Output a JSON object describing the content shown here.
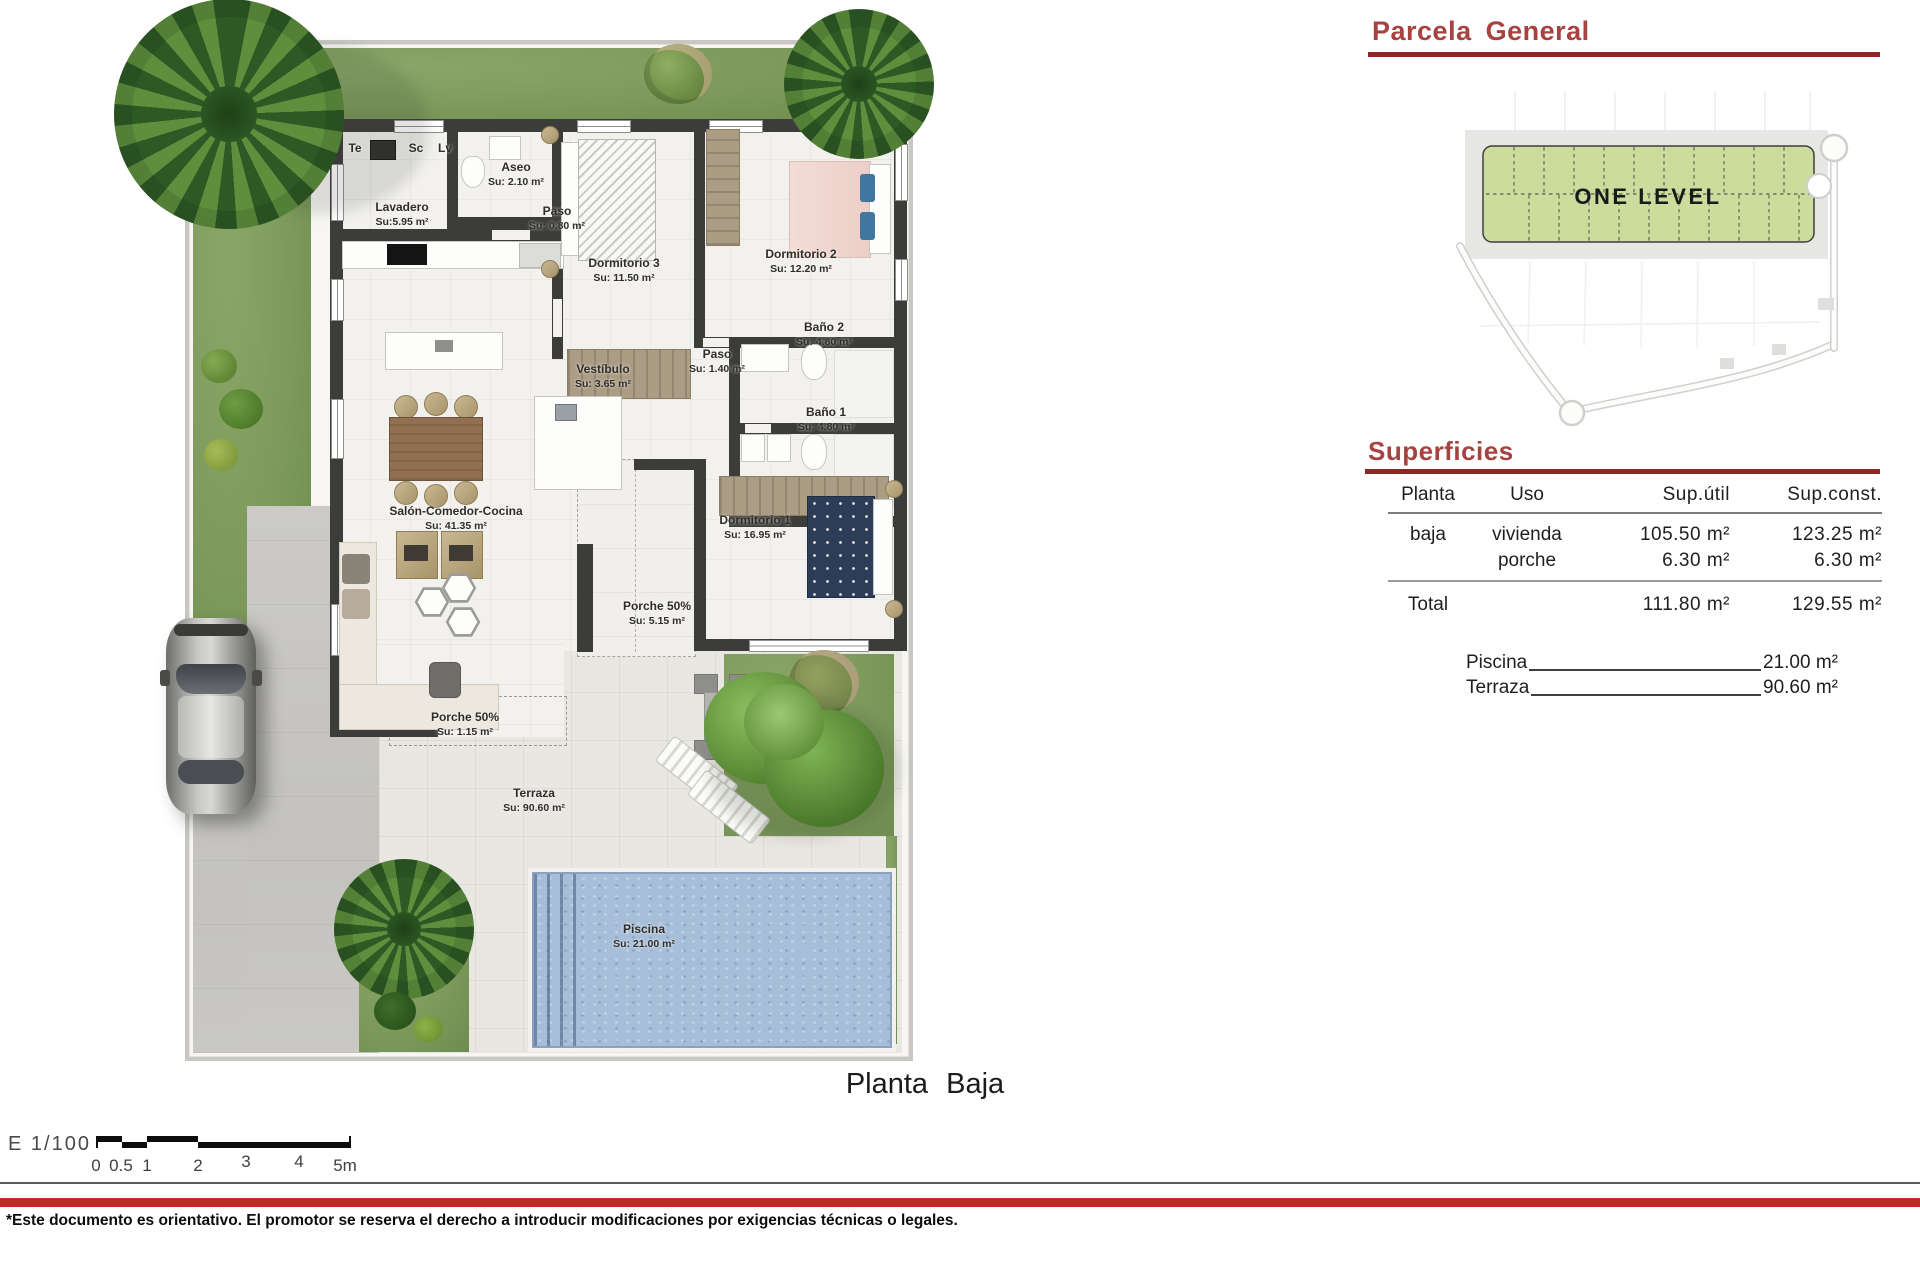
{
  "document": {
    "plan_title": "Planta Baja",
    "scale": {
      "label": "E 1/100",
      "ticks": [
        "0",
        "0.5",
        "1",
        "2",
        "3",
        "4",
        "5m"
      ]
    },
    "disclaimer": "*Este documento es orientativo. El promotor se reserva el derecho a introducir modificaciones por exigencias técnicas o legales."
  },
  "plan": {
    "appliances": [
      {
        "label": "Te"
      },
      {
        "label": "Sc"
      },
      {
        "label": "Lv"
      }
    ],
    "rooms": [
      {
        "name": "Aseo",
        "area": "Su: 2.10 m²"
      },
      {
        "name": "Lavadero",
        "area": "Su:5.95 m²"
      },
      {
        "name": "Paso",
        "area": "Su: 0.80 m²"
      },
      {
        "name": "Dormitorio 3",
        "area": "Su: 11.50 m²"
      },
      {
        "name": "Dormitorio 2",
        "area": "Su: 12.20 m²"
      },
      {
        "name": "Baño 2",
        "area": "Su: 4.80 m²"
      },
      {
        "name": "Paso",
        "area": "Su: 1.40 m²"
      },
      {
        "name": "Baño 1",
        "area": "Su: 4.80 m²"
      },
      {
        "name": "Vestíbulo",
        "area": "Su: 3.65 m²"
      },
      {
        "name": "Salón-Comedor-Cocina",
        "area": "Su: 41.35 m²"
      },
      {
        "name": "Dormitorio 1",
        "area": "Su: 16.95 m²"
      },
      {
        "name": "Porche 50%",
        "area": "Su: 5.15 m²"
      },
      {
        "name": "Porche 50%",
        "area": "Su: 1.15 m²"
      },
      {
        "name": "Terraza",
        "area": "Su: 90.60 m²"
      },
      {
        "name": "Piscina",
        "area": "Su: 21.00 m²"
      }
    ]
  },
  "parcela": {
    "title": "Parcela General",
    "site_label": "ONE LEVEL"
  },
  "superficies": {
    "title": "Superficies",
    "columns": [
      "Planta",
      "Uso",
      "Sup.útil",
      "Sup.const."
    ],
    "rows": [
      {
        "planta": "baja",
        "uso": "vivienda",
        "util": "105.50 m²",
        "const": "123.25 m²"
      },
      {
        "planta": "",
        "uso": "porche",
        "util": "6.30 m²",
        "const": "6.30 m²"
      }
    ],
    "total": {
      "label": "Total",
      "util": "111.80 m²",
      "const": "129.55 m²"
    },
    "extras": [
      {
        "label": "Piscina",
        "value": "21.00 m²"
      },
      {
        "label": "Terraza",
        "value": "90.60 m²"
      }
    ]
  },
  "colors": {
    "heading_red": "#a64340",
    "rule_red": "#8e2724",
    "footer_red": "#bf2a27",
    "wall": "#3c3c3a",
    "grass": "#7d9a5c",
    "pool_water": "#a7bed8",
    "site_green": "#cbdc9c"
  }
}
